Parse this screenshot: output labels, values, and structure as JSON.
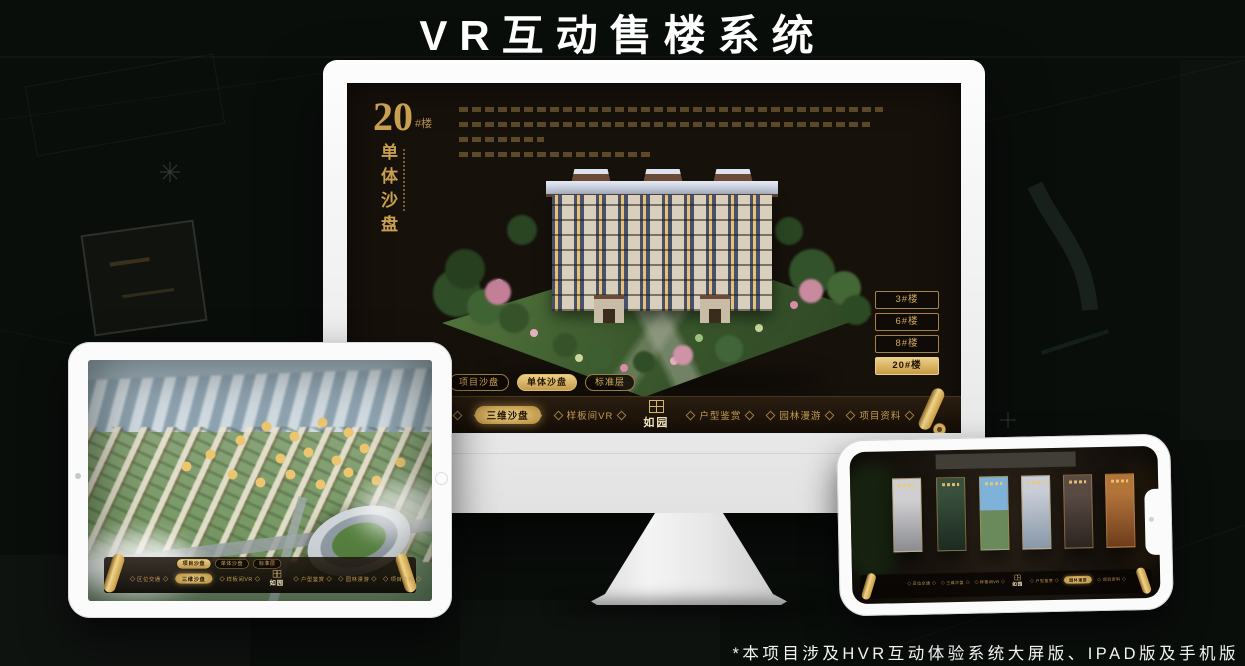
{
  "poster": {
    "title": "VR互动售楼系统",
    "footnote": "*本项目涉及HVR互动体验系统大屏版、IPAD版及手机版"
  },
  "colors": {
    "gold": "#c8a050",
    "gold_bright": "#ecd08a",
    "screen_bg": "#17110b",
    "page_bg": "#0a0e0b"
  },
  "monitor_ui": {
    "section_number": "20",
    "section_number_suffix": "#楼",
    "section_title": "单体沙盘",
    "logo": "如园",
    "floor_buttons": [
      {
        "label": "3#楼",
        "active": false
      },
      {
        "label": "6#楼",
        "active": false
      },
      {
        "label": "8#楼",
        "active": false
      },
      {
        "label": "20#楼",
        "active": true
      }
    ],
    "tabs": [
      {
        "label": "项目沙盘",
        "active": false
      },
      {
        "label": "单体沙盘",
        "active": true
      },
      {
        "label": "标准层",
        "active": false
      }
    ],
    "nav_left": [
      {
        "label": "区位交通",
        "active": false
      },
      {
        "label": "三维沙盘",
        "active": true
      },
      {
        "label": "样板间VR",
        "active": false
      }
    ],
    "nav_right": [
      {
        "label": "户型鉴赏",
        "active": false
      },
      {
        "label": "园林漫游",
        "active": false
      },
      {
        "label": "项目资料",
        "active": false
      }
    ]
  },
  "tablet_ui": {
    "logo": "如园",
    "tabs": [
      {
        "label": "项目沙盘",
        "active": true
      },
      {
        "label": "单体沙盘",
        "active": false
      },
      {
        "label": "标准层",
        "active": false
      }
    ],
    "nav_left": [
      {
        "label": "区位交通",
        "active": false
      },
      {
        "label": "三维沙盘",
        "active": true
      },
      {
        "label": "样板间VR",
        "active": false
      }
    ],
    "nav_right": [
      {
        "label": "户型鉴赏",
        "active": false
      },
      {
        "label": "园林漫游",
        "active": false
      },
      {
        "label": "项目资料",
        "active": false
      }
    ]
  },
  "phone_ui": {
    "logo": "如园",
    "nav_left": [
      {
        "label": "区位交通",
        "active": false
      },
      {
        "label": "三维沙盘",
        "active": false
      },
      {
        "label": "样板间VR",
        "active": false
      }
    ],
    "nav_right": [
      {
        "label": "户型鉴赏",
        "active": false
      },
      {
        "label": "园林漫游",
        "active": true
      },
      {
        "label": "项目资料",
        "active": false
      }
    ]
  }
}
